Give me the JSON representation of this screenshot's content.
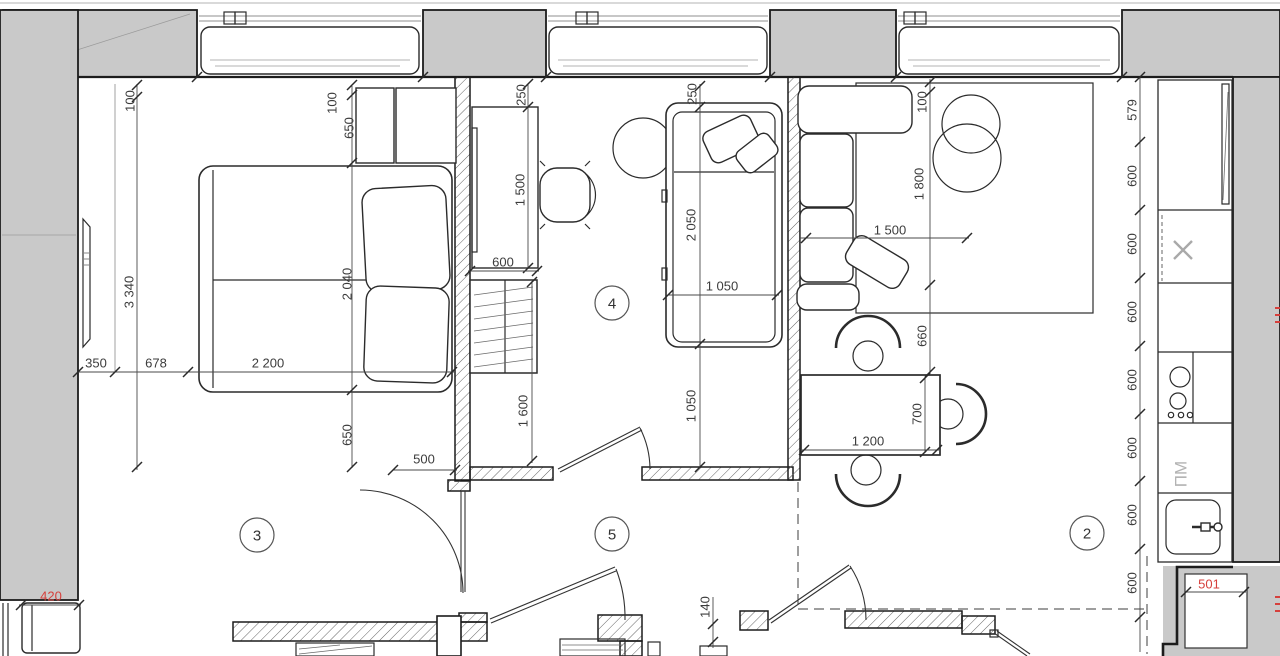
{
  "plan": {
    "type": "apartment-floor-plan",
    "colors": {
      "wall_gray": "#c9c9c9",
      "line": "#1c1c1c",
      "dim_text": "#3c3c3c",
      "red": "#d6403c",
      "muted_gray": "#b3b3b3"
    },
    "room_markers": {
      "bedroom": "3",
      "kids": "4",
      "hall": "5",
      "kitchen_living": "2"
    },
    "labels": {
      "dishwasher": "ПМ"
    },
    "dims": {
      "bedroom": {
        "top_gap": "100",
        "height": "3 340",
        "closet_gap": "100",
        "closet_depth": "650",
        "bed_length": "2 040",
        "bottom_inset": "650",
        "left_gap": "350",
        "side_gap": "678",
        "bed_width": "2 200",
        "door_wall": "500"
      },
      "balcony": {
        "depth": "420"
      },
      "kids": {
        "desk_gap": "250",
        "desk_length": "1 500",
        "desk_depth": "600",
        "wardrobe_length": "1 600",
        "bed_gap": "250",
        "bed_length": "2 050",
        "bed_width": "1 050",
        "clearance": "1 050"
      },
      "living": {
        "rug_gap": "100",
        "rug_length": "1 800",
        "sofa_width": "1 500",
        "table_gap": "660",
        "table_width": "700",
        "table_length": "1 200"
      },
      "hall": {
        "wall_step": "140"
      },
      "kitchen": {
        "run": [
          "579",
          "600",
          "600",
          "600",
          "600",
          "600",
          "600",
          "600"
        ],
        "niche_width": "501"
      }
    }
  }
}
